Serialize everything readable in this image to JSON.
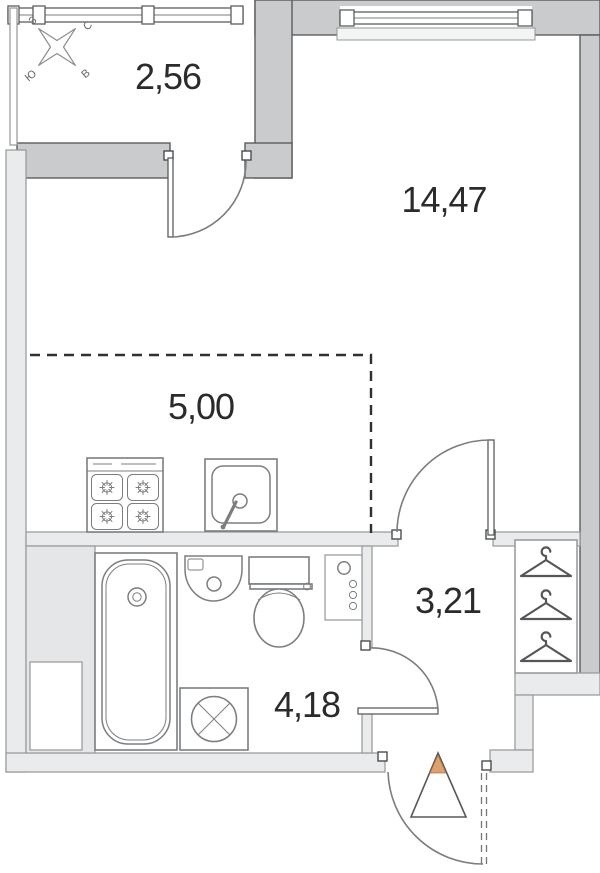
{
  "rooms": {
    "balcony": {
      "area": "2,56"
    },
    "living_room": {
      "area": "14,47"
    },
    "kitchen": {
      "area": "5,00"
    },
    "bathroom": {
      "area": "4,18"
    },
    "hallway": {
      "area": "3,21"
    }
  },
  "compass": {
    "north": "С",
    "east": "В",
    "south": "Ю",
    "west": "З"
  },
  "wardrobe": {
    "hangers": 3
  },
  "icons": [
    "compass-rose-icon",
    "stove-icon",
    "kitchen-sink-icon",
    "bathtub-icon",
    "wash-basin-icon",
    "toilet-icon",
    "washing-machine-icon",
    "utility-panel-icon",
    "hanger-icon",
    "entrance-triangle-icon"
  ],
  "colors": {
    "wall_dark": "#c9cbcd",
    "wall_light": "#eaebec",
    "wall_block": "#e5e6e8",
    "outline_dark": "#5a5d5f",
    "outline_light": "#94979a",
    "fixture_line": "#7b7e81",
    "text": "#2b2b2d",
    "dash": "#2f3032",
    "entrance_accent": "#dfa070",
    "background": "#ffffff"
  }
}
